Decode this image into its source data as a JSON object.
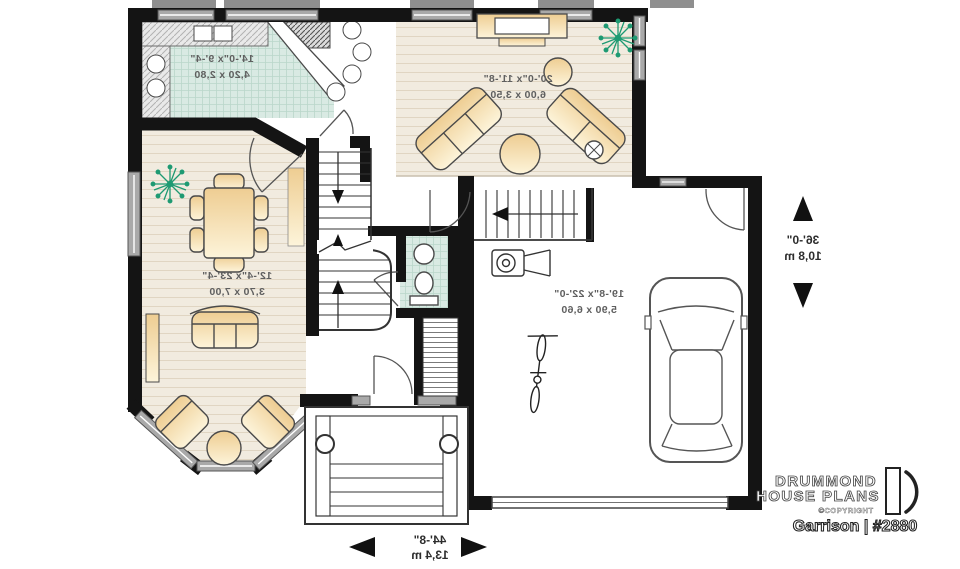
{
  "plan": {
    "rooms": [
      {
        "id": "kitchen",
        "imperial": "14'-0\"x 9'-4\"",
        "metric": "4,20 x 2,80"
      },
      {
        "id": "living-room",
        "imperial": "20'-0\"x 11'-8\"",
        "metric": "6,00 x 3,50"
      },
      {
        "id": "dining-room",
        "imperial": "12'-4\"x 23'-4\"",
        "metric": "3,70 x 7,00"
      },
      {
        "id": "garage",
        "imperial": "19'-8\"x 22'-0\"",
        "metric": "5,90 x 6,60"
      }
    ],
    "overall": {
      "depth": {
        "imperial": "36'-0\"",
        "metric": "10,8 m"
      },
      "width": {
        "imperial": "44'-8\"",
        "metric": "13,4 m"
      }
    },
    "note": "mirrored (reverse) floor plan view"
  },
  "branding": {
    "company_line1": "DRUMMOND",
    "company_line2": "HOUSE PLANS",
    "copyright": "©COPYRIGHT",
    "plan_name": "Garrison | #2880"
  },
  "colors": {
    "wall": "#141414",
    "window": "#a9a9a9",
    "wood_floor": "#f1ebdf",
    "tile_floor": "#d9eae3",
    "furniture": "#f0d09a",
    "plant": "#1e9a72",
    "label_text": "#5f5f5f"
  }
}
